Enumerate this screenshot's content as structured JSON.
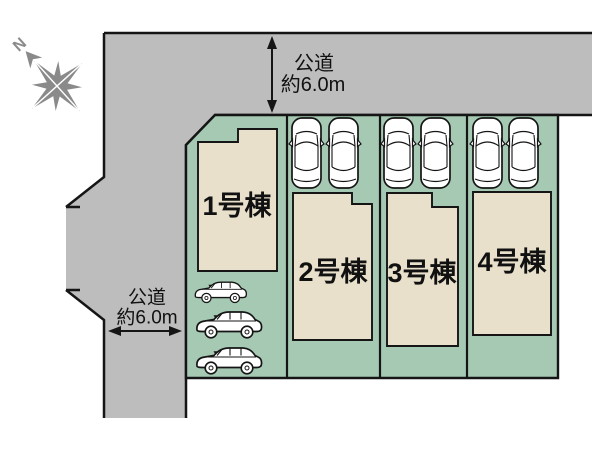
{
  "plan": {
    "compass": {
      "label": "N"
    },
    "road_top": {
      "name": "公道",
      "width": "約6.0m"
    },
    "road_left": {
      "name": "公道",
      "width": "約6.0m"
    },
    "lots": [
      {
        "label": "1号棟"
      },
      {
        "label": "2号棟"
      },
      {
        "label": "3号棟"
      },
      {
        "label": "4号棟"
      }
    ],
    "parking": {
      "top_view_cars": 6,
      "side_view_cars": 3
    },
    "colors": {
      "background": "#ffffff",
      "road": "#bdbdbd",
      "plot": "#a6c9b4",
      "building": "#e8e0cb",
      "outline": "#151515",
      "compass": "#8a8a8a",
      "car_body": "#ffffff"
    }
  }
}
